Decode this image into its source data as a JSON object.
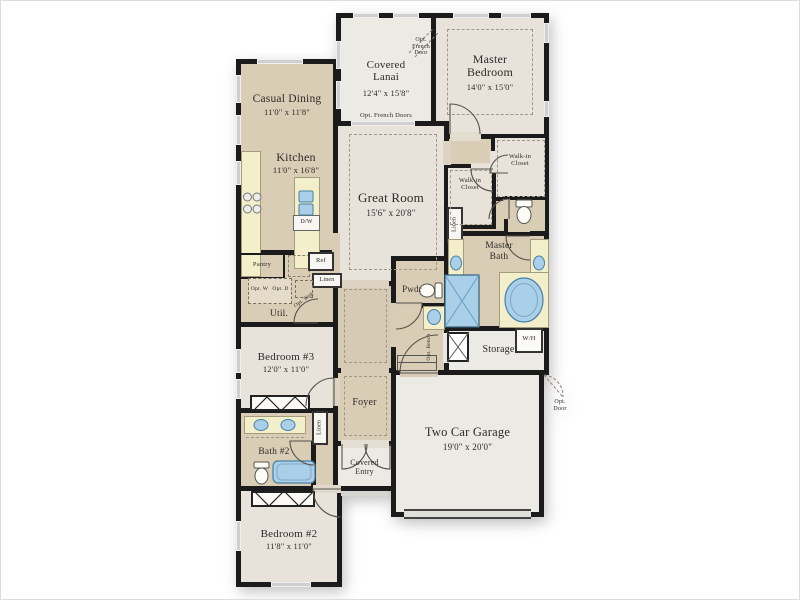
{
  "plan": {
    "rooms": {
      "covered_lanai": {
        "name": "Covered Lanai",
        "dims": "12'4\" x 15'8\""
      },
      "master_bedroom": {
        "name": "Master Bedroom",
        "dims": "14'0\" x 15'0\""
      },
      "casual_dining": {
        "name": "Casual Dining",
        "dims": "11'0\" x 11'8\""
      },
      "kitchen": {
        "name": "Kitchen",
        "dims": "11'0\" x 16'8\""
      },
      "great_room": {
        "name": "Great Room",
        "dims": "15'6\" x 20'8\""
      },
      "bedroom_3": {
        "name": "Bedroom #3",
        "dims": "12'0\" x 11'0\""
      },
      "bedroom_2": {
        "name": "Bedroom #2",
        "dims": "11'8\" x 11'0\""
      },
      "two_car_garage": {
        "name": "Two Car Garage",
        "dims": "19'0\" x 20'0\""
      },
      "bath_2": {
        "name": "Bath #2"
      },
      "master_bath": {
        "name": "Master Bath"
      },
      "walk_in_closet": {
        "name": "Walk-in Closet"
      },
      "util": {
        "name": "Util."
      },
      "pwdr": {
        "name": "Pwdr"
      },
      "foyer": {
        "name": "Foyer"
      },
      "storage": {
        "name": "Storage"
      },
      "covered_entry": {
        "name": "Covered Entry"
      }
    },
    "annotations": {
      "opt_french_door": "Opt. French Door",
      "opt_french_doors": "Opt. French Doors",
      "opt_door": "Opt. Door",
      "pantry": "Pantry",
      "ref": "Ref",
      "linen": "Linen",
      "opt_w": "Opt. W",
      "opt_d": "Opt. D",
      "opt_sink": "Opt. Sink",
      "dw": "D/W",
      "opt_bench": "Opt. Bench",
      "wh": "W/H"
    },
    "colors": {
      "wall": "#1b1b1b",
      "tan": "#d9cdb6",
      "room_gray": "#e8e3da",
      "light_gray": "#ebeae5",
      "counter": "#f3efca",
      "fixture_blue": "#a9cfe9"
    }
  }
}
